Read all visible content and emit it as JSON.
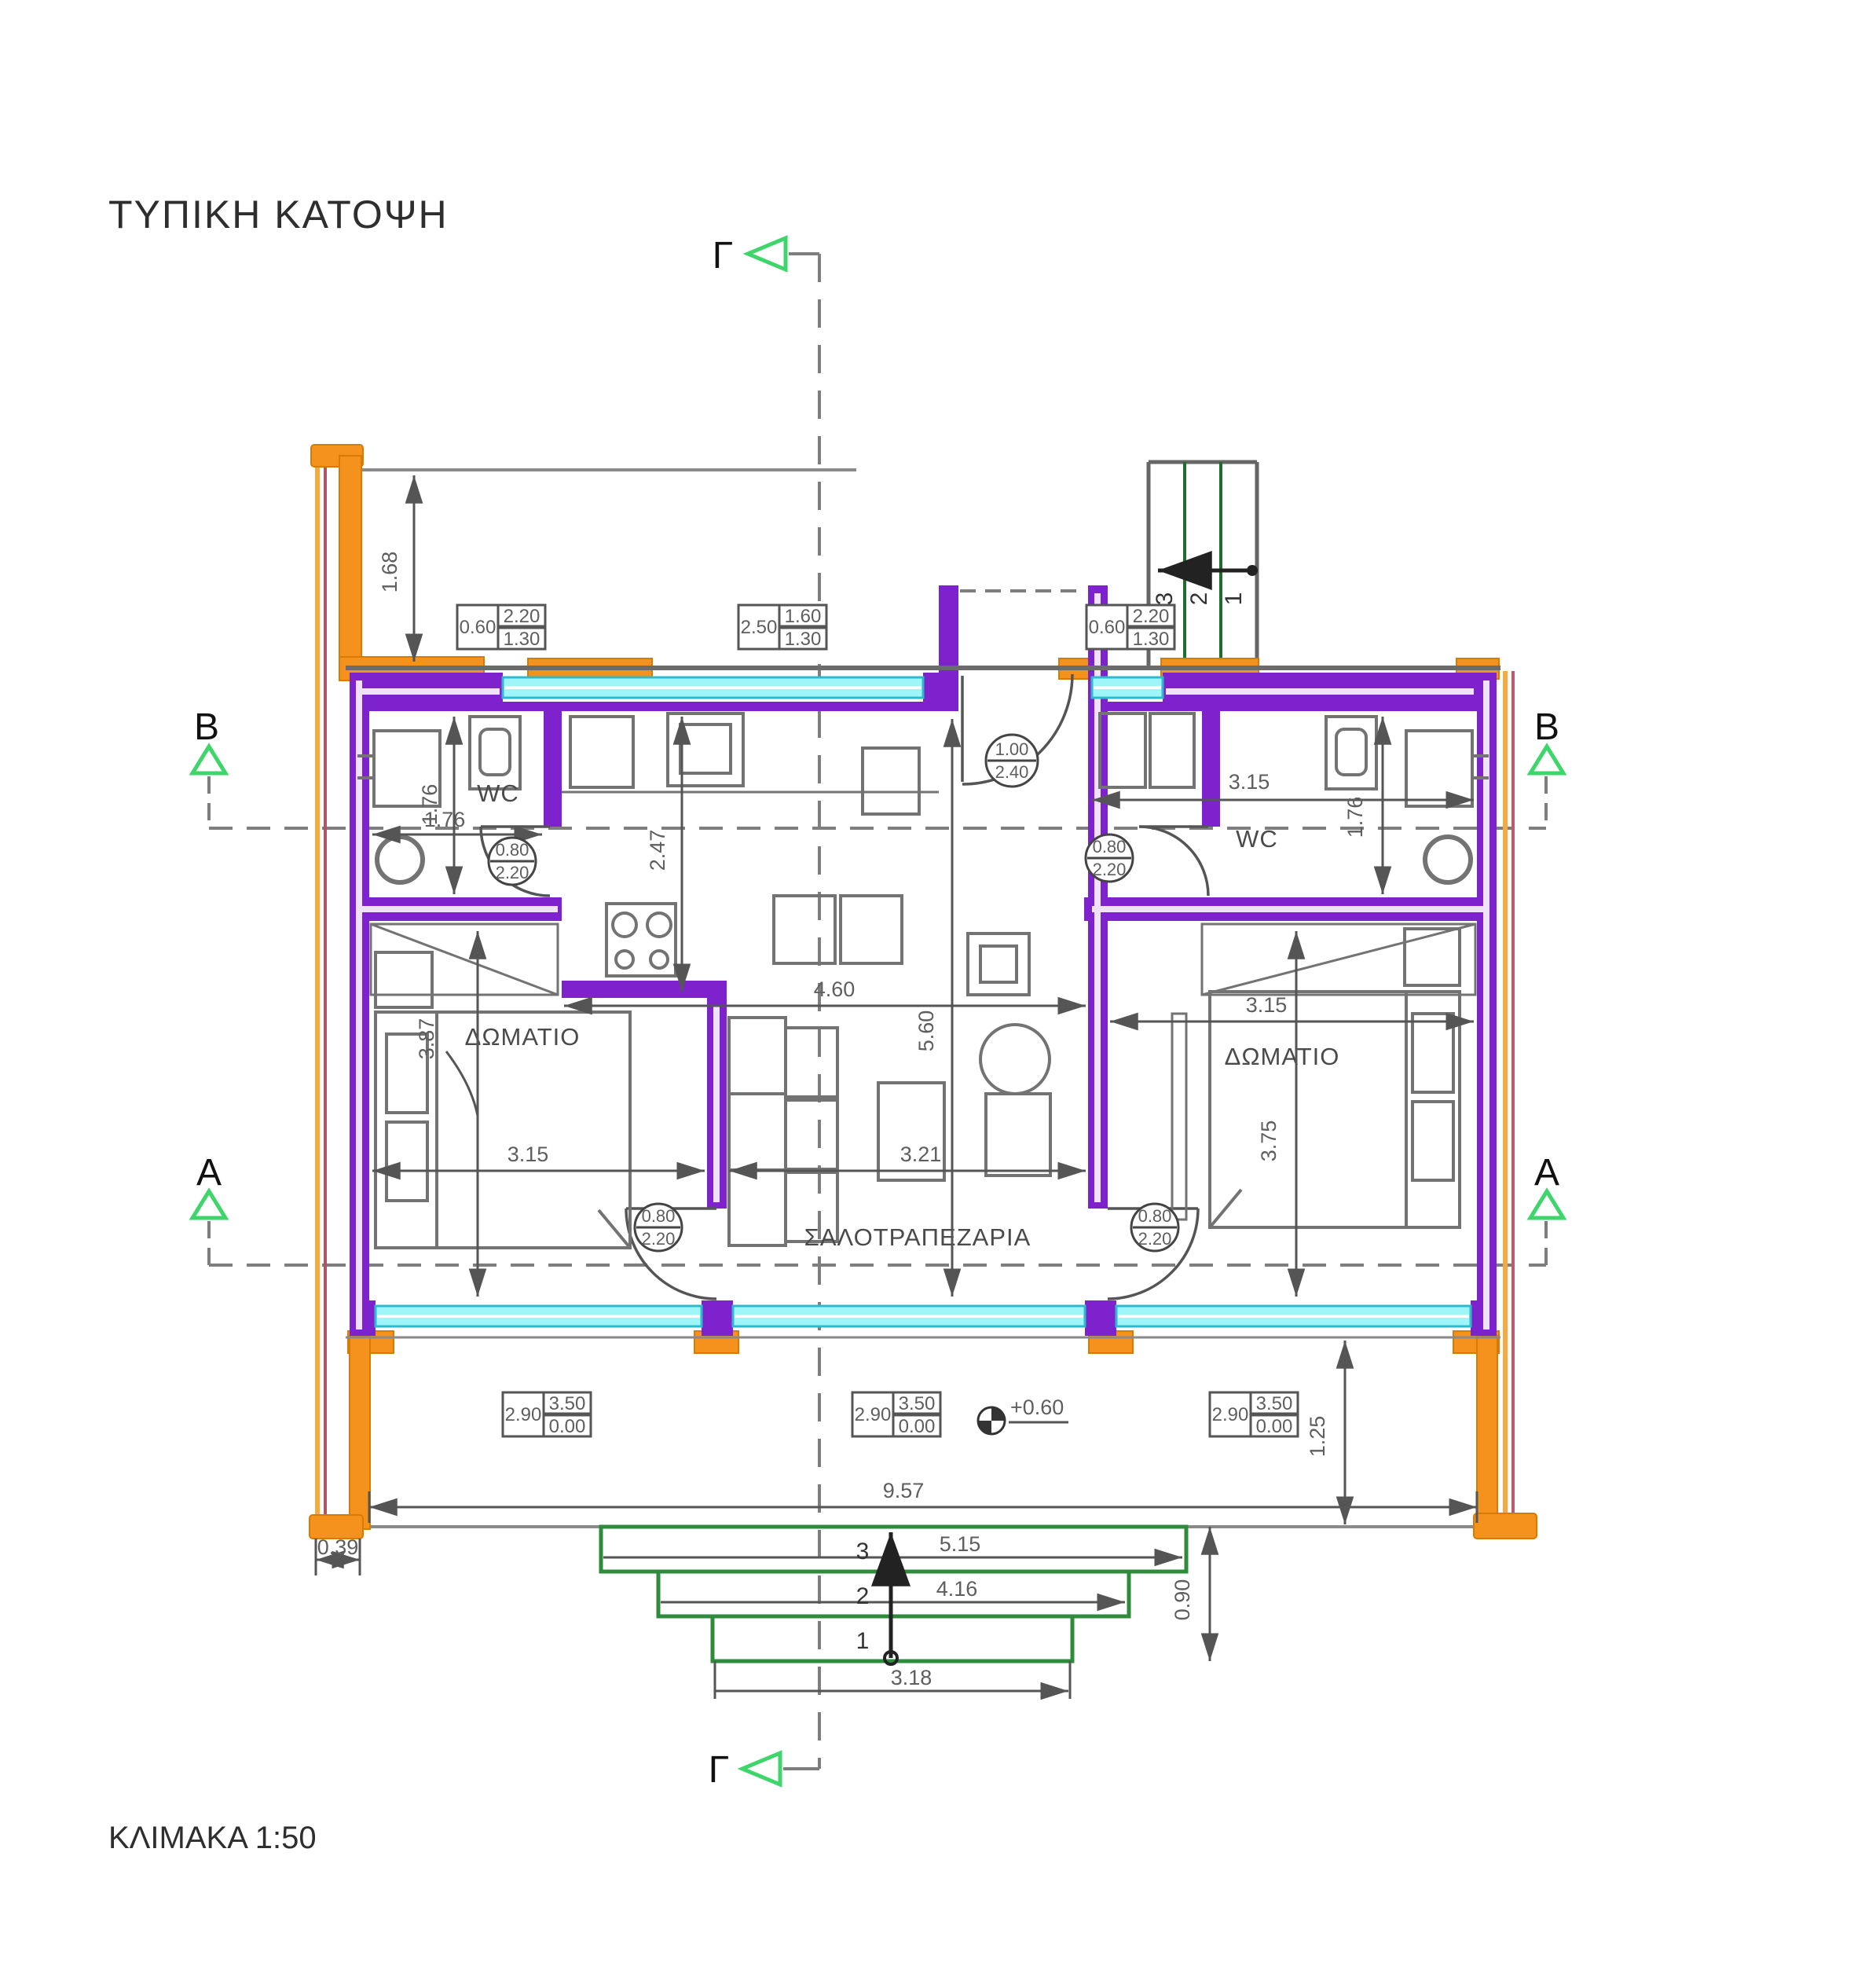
{
  "title": "ΤΥΠΙΚΗ ΚΑΤΟΨΗ",
  "scale_label": "ΚΛΙΜΑΚΑ 1:50",
  "section_markers": {
    "gamma_top": "Γ",
    "gamma_bottom": "Γ",
    "b_left": "B",
    "b_right": "B",
    "a_left": "A",
    "a_right": "A"
  },
  "rooms": {
    "wc_left": "WC",
    "wc_right": "WC",
    "bedroom_left": "ΔΩΜΑΤΙΟ",
    "bedroom_right": "ΔΩΜΑΤΙΟ",
    "living": "ΣΑΛΟΤΡΑΠΕΖΑΡΙΑ"
  },
  "dimensions": {
    "balcony_top_depth": "1.68",
    "wc_left_depth_v": "1.76",
    "wc_left_width_h": "1.76",
    "kitchen_depth": "2.47",
    "kitchen_living_width": "4.60",
    "living_depth": "5.60",
    "bedroom_left_depth": "3.87",
    "bedroom_left_width": "3.15",
    "living_width": "3.21",
    "hall_wc_right_width": "3.15",
    "wc_right_depth": "1.76",
    "bedroom_right_width": "3.15",
    "bedroom_right_depth": "3.75",
    "balcony_total_width": "9.57",
    "balcony_depth": "1.25",
    "parapet_width": "0.39",
    "step3_width": "5.15",
    "step2_width": "4.16",
    "step1_width": "3.18",
    "steps_depth": "0.90"
  },
  "level_marker": "+0.60",
  "window_schedules": {
    "top_left": {
      "w": "0.60",
      "a": "2.20",
      "b": "1.30"
    },
    "top_mid": {
      "w": "2.50",
      "a": "1.60",
      "b": "1.30"
    },
    "top_right": {
      "w": "0.60",
      "a": "2.20",
      "b": "1.30"
    },
    "balc_left": {
      "w": "2.90",
      "a": "3.50",
      "b": "0.00"
    },
    "balc_mid": {
      "w": "2.90",
      "a": "3.50",
      "b": "0.00"
    },
    "balc_right": {
      "w": "2.90",
      "a": "3.50",
      "b": "0.00"
    }
  },
  "door_tags": {
    "wc_left": {
      "a": "0.80",
      "b": "2.20"
    },
    "wc_right": {
      "a": "0.80",
      "b": "2.20"
    },
    "bed_left": {
      "a": "0.80",
      "b": "2.20"
    },
    "bed_right": {
      "a": "0.80",
      "b": "2.20"
    },
    "entrance": {
      "a": "1.00",
      "b": "2.40"
    }
  },
  "stairs_top_numbers": {
    "n3": "3",
    "n2": "2",
    "n1": "1"
  },
  "steps_bottom_numbers": {
    "n3": "3",
    "n2": "2",
    "n1": "1"
  },
  "colors": {
    "wall_purple": "#7d22cc",
    "wall_core": "#f0e2fb",
    "accent_orange": "#f5921e",
    "window_cyan": "#9ff6f9",
    "window_border": "#2fb9ce",
    "marker_green": "#3ed56b",
    "steps_green": "#2e8b3c",
    "line_gray": "#6b6b6b"
  }
}
